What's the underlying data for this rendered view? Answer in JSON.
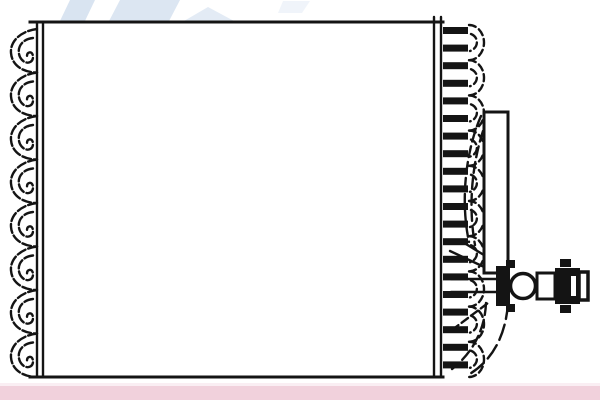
{
  "image": {
    "type": "technical-line-drawing",
    "subject": "Automotive A/C evaporator / heat-exchanger core with side tube stack and service fitting",
    "visible_text": ""
  },
  "colors": {
    "line": "#141414",
    "watermark": "#b9cde6",
    "accent_bar": "#f1d1dc",
    "paper": "#ffffff"
  },
  "parts": {
    "watermark": "pale blue logo watermark, cropped at top edge",
    "core_face": "blank rectangular core face",
    "left_fin_pack": "corrugated fin edge, left side",
    "left_side_plate": "double-line side plate, left",
    "tube_stack": "tube-and-fin stack ladder, right side",
    "right_fin_edge": "scalloped fin edge, right side",
    "inlet_pipe": "vertical inlet pipe",
    "connector_tubes": "curved connector tubes between stack and pipe",
    "outlet_bend": "outlet pipe bend sweeping to bottom edge",
    "service_fitting": "horizontal service fitting with flange, nut and valve cap",
    "accent_bar": "pink footer bar"
  },
  "counts": {
    "left_fin_loops": 8,
    "tube_rows": 20,
    "right_fin_scallops": 10,
    "watermark_fragments": 4
  }
}
